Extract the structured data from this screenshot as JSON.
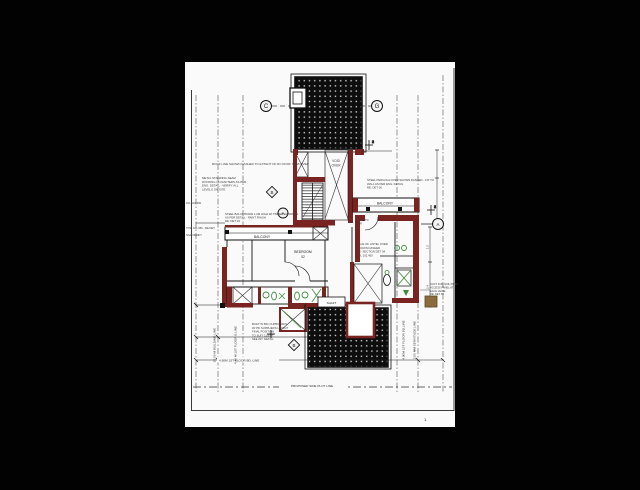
{
  "page": {
    "background": "#000000",
    "sheet": "#fafafa"
  },
  "colors": {
    "wall_red": "#7a2422",
    "wall_red_dark": "#5c1a18",
    "fixture_green": "#3d8b3d",
    "deck_black": "#0d0d0d",
    "door_tan": "#8a6d3b",
    "line": "#1c1c1c"
  },
  "grid_bubbles": {
    "c": "C",
    "g": "G",
    "b_mid": "B",
    "a_mid": "A",
    "a_right": "A",
    "b_bottom": "B"
  },
  "level_markers": {
    "top": "2",
    "right": "2"
  },
  "room_labels": {
    "void_1": "VOID",
    "void_2": "OVER",
    "balcony_left": "BALCONY",
    "bedroom": "BEDROOM",
    "bedroom_no": "02",
    "balcony_right": "BALCONY",
    "shaft": "SHAFT",
    "door_1": "900 STD",
    "door_2": "DR"
  },
  "notes": {
    "roof_line": "ROOF LINE SHOWN DASHED TO EXTENT OF RC ROOF SLAB OVER",
    "left_block": [
      "METAL STANDING SEAM",
      "ROOFING ON RAFTERS AS PER",
      "ENG. DETAIL - VERIFY ALL",
      "LEVELS ON SITE"
    ],
    "balcony_note": [
      "STEEL BALUSTRADE 1.0M HIGH W/ TIMBER HANDRAIL",
      "AS PER DETAIL - PAINT FINISH",
      "RE: DET 03"
    ],
    "right_balcony_note": [
      "STEEL PERGOLA OVER SHOWN DASHED - FIX TO",
      "WALL AS PER ENG. DETAIL",
      "RE: DET 06"
    ],
    "right_room_note": [
      "FACE OF LINTEL OVER",
      "SHOWN DASHED",
      "RE: SECTION DET 04",
      "FFL 102.450"
    ],
    "bottom_left_note": [
      "BUILT IN BIC CUPBOARDS",
      "W/ PD SUPPLIERS LAYOUT",
      "FINAL POSITION",
      "TO SUIT CLIENT",
      "SEE INT. DETAIL"
    ],
    "right_margin_note": [
      "DUCT FOR SOIL PIPES",
      "ACCESS PANEL AT",
      "EACH LEVEL",
      "RE: DET 09"
    ],
    "left_margin_1": "FFL 101.500",
    "left_margin_2": "TOW 101.950 - RE DET",
    "left_margin_3": "NGL VERIFY"
  },
  "dimensions": {
    "v_building_line": "20.00 M BUILDING LINE",
    "v_floor_line_left": "4.90 M 1ST FLOOR B.LINE",
    "v_floor_line_right": "4.90M 1ST FLOOR BD.LINE",
    "v_servitude": "2.00 MM SERVITUDE LINE",
    "h_floor_line": "4.90M 1ST FLOOR BD. LINE",
    "h_plot_line": "PROPOSED SIDE PLOT LINE",
    "dim_1": "1.5",
    "dim_2": "2.4",
    "page_mark": "1."
  }
}
